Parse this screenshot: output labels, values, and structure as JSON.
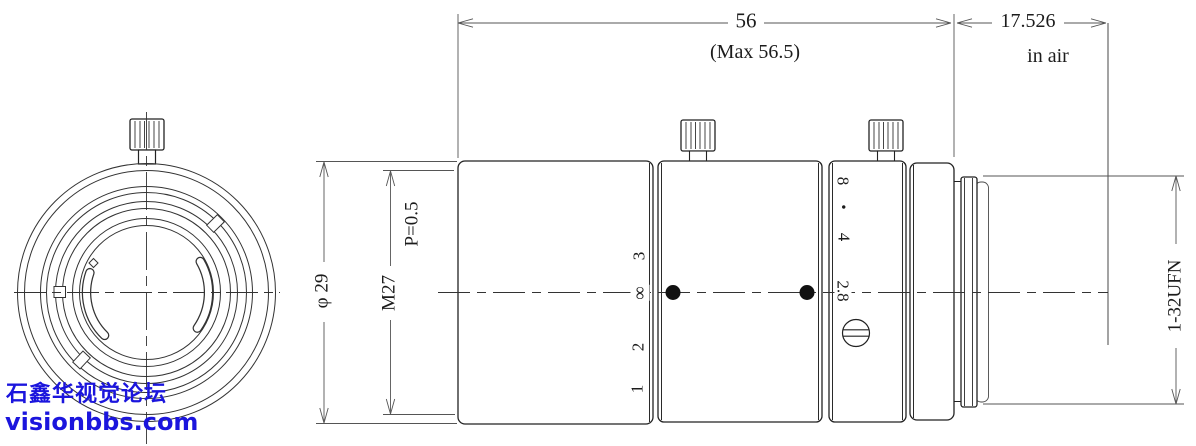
{
  "dimensions": {
    "length_main": "56",
    "length_max": "(Max 56.5)",
    "flange_distance": "17.526",
    "flange_note": "in air",
    "outer_diameter": "φ 29",
    "filter_thread": "M27",
    "thread_pitch": "P=0.5",
    "mount_thread": "1-32UFN"
  },
  "focus_scale": {
    "marks": [
      "3",
      "∞",
      "2",
      "1"
    ]
  },
  "aperture_scale": {
    "marks": [
      "8",
      "•",
      "4",
      "2.8"
    ]
  },
  "watermark": {
    "line1": "石鑫华视觉论坛",
    "line2": "visionbbs.com"
  },
  "colors": {
    "object_line": "#1f1f1f",
    "dimension_line": "#555555",
    "watermark_blue": "#1b15dd",
    "background": "#ffffff"
  }
}
